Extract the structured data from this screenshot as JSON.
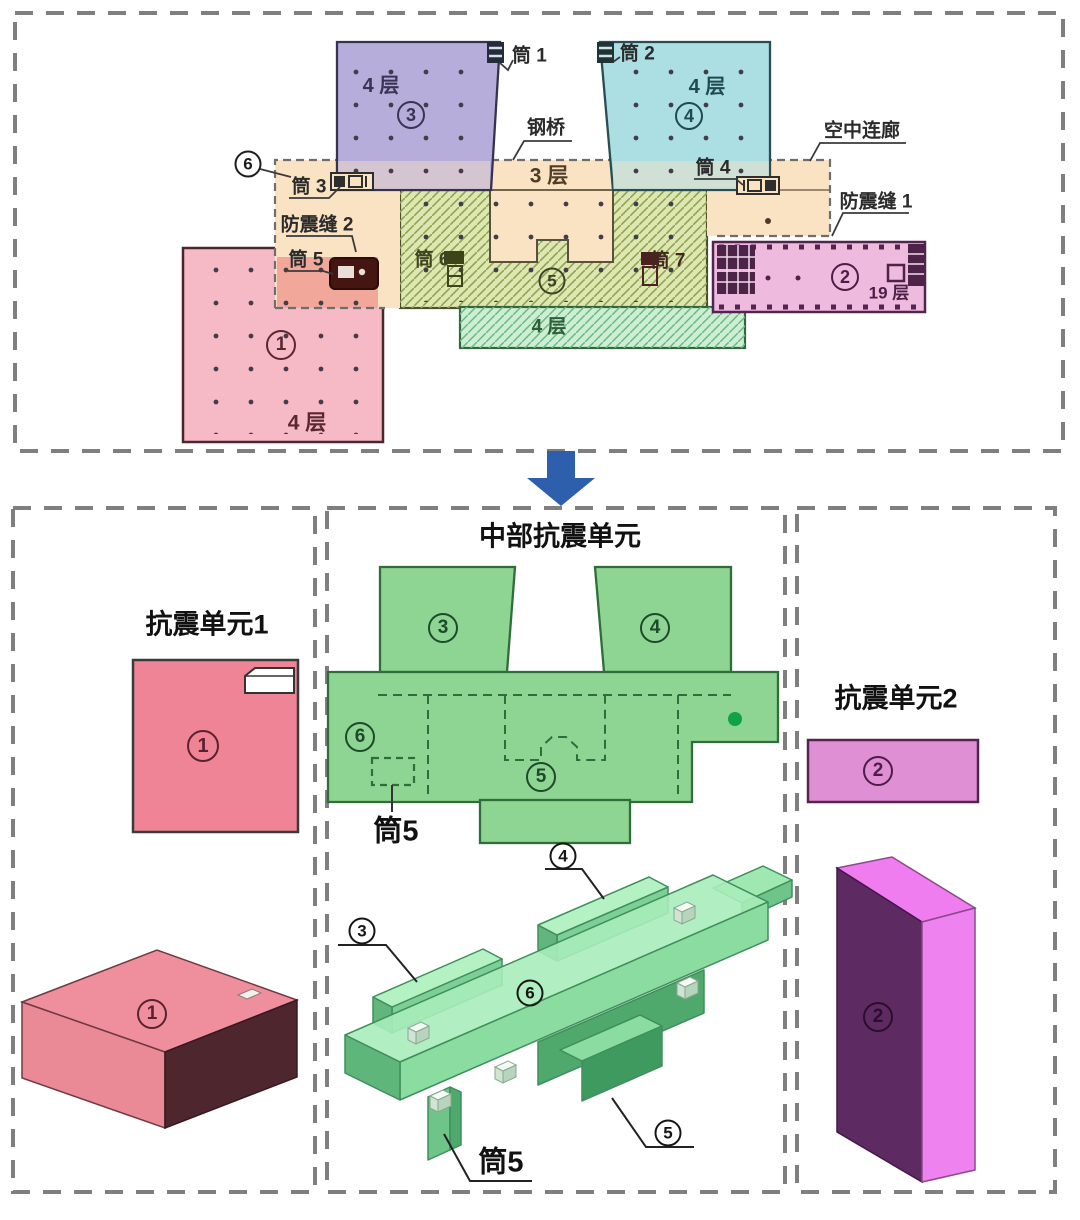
{
  "colors": {
    "zone1_pink": "#f6b9c6",
    "zone2_magenta": "#eebbdf",
    "zone3_purple": "#b7addb",
    "zone4_cyan": "#abdfe4",
    "zone5_olive_hatch": "#dde7b2",
    "zone6_corridor_orange": "#fae3c3",
    "lower_4f_green": "#cdeed4",
    "tong5_salmon": "#f1a89b",
    "central_plan_green": "#8ed492",
    "iso_green": "#a9ecba",
    "iso_pink_top": "#ef8f9d",
    "iso_pink_dark": "#4e262e",
    "iso_magenta_bright": "#ee82ee",
    "iso_magenta_dark": "#5d2b61",
    "arrow_blue": "#2e5fac",
    "green_dot": "#12a14b"
  },
  "top_plan": {
    "zones": {
      "z1": {
        "num": "1",
        "floors": "4 层"
      },
      "z2": {
        "num": "2",
        "floors": "19 层"
      },
      "z3": {
        "num": "3",
        "floors": "4 层"
      },
      "z4": {
        "num": "4",
        "floors": "4 层"
      },
      "z5": {
        "num": "5"
      },
      "z6": {
        "num": "6"
      },
      "lower": {
        "floors": "4 层"
      },
      "bridge_band": {
        "floors": "3 层"
      }
    },
    "annotations": {
      "tong1": "筒 1",
      "tong2": "筒 2",
      "tong3": "筒 3",
      "tong4": "筒 4",
      "tong5": "筒 5",
      "tong6": "筒 6",
      "tong7": "筒 7",
      "steel_bridge": "钢桥",
      "sky_corridor": "空中连廊",
      "seismic_joint1": "防震缝 1",
      "seismic_joint2": "防震缝 2"
    }
  },
  "unit1": {
    "title": "抗震单元1",
    "plan_num": "1",
    "iso_num": "1"
  },
  "central_unit": {
    "title": "中部抗震单元",
    "plan": {
      "z3": "3",
      "z4": "4",
      "z5": "5",
      "z6": "6",
      "tong5": "筒5"
    },
    "iso": {
      "z3": "3",
      "z4": "4",
      "z5": "5",
      "z6": "6",
      "tong5": "筒5"
    }
  },
  "unit2": {
    "title": "抗震单元2",
    "plan_num": "2",
    "iso_num": "2"
  }
}
